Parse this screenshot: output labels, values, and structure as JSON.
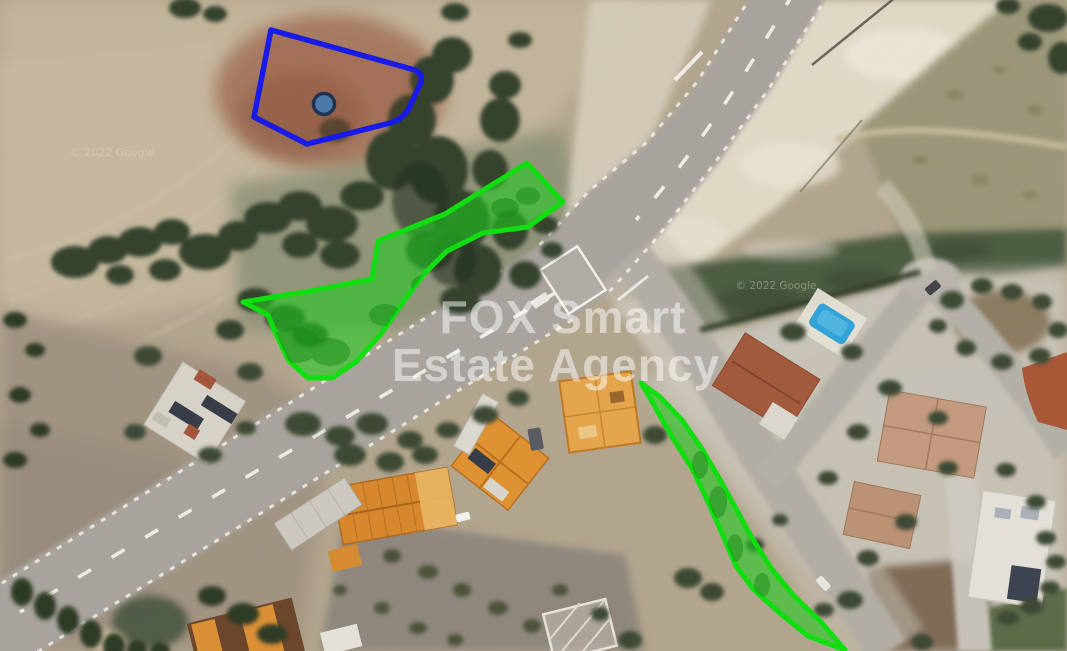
{
  "watermark": {
    "line1": "FOX Smart",
    "line2": "Estate Agency"
  },
  "copyright": {
    "left": "© 2022 Google",
    "right": "© 2022 Google"
  },
  "colors": {
    "parcel_green_stroke": "#0cdf0c",
    "parcel_green_fill": "rgba(30,205,30,0.58)",
    "parcel_blue_stroke": "#1517e9",
    "parcel_blue_fill": "rgba(140,60,30,0.14)",
    "marker_fill": "#4678a8",
    "marker_stroke": "#1e3050",
    "watermark_color": "#ffffff",
    "pool_color": "#2fa3d8"
  }
}
